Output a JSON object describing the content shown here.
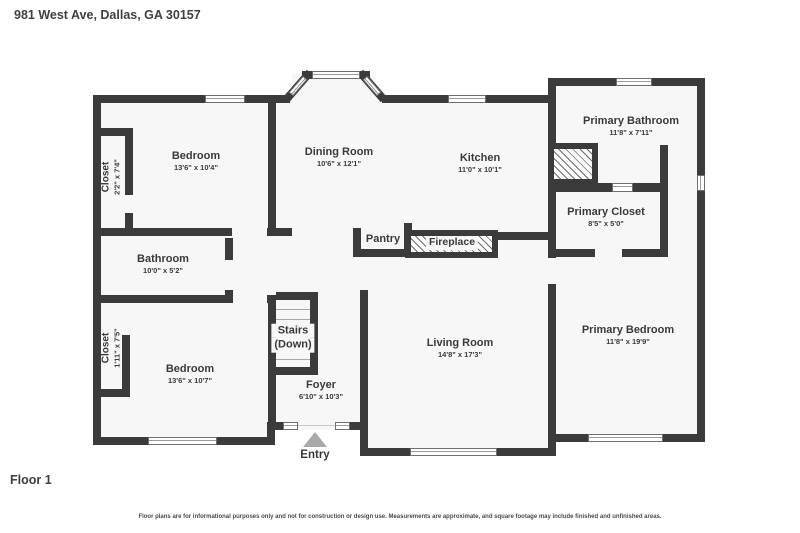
{
  "title": "981 West Ave, Dallas, GA 30157",
  "floor_label": "Floor 1",
  "disclaimer": "Floor plans are for informational purposes only and not for construction or design use. Measurements are approximate, and square footage may include finished and unfinished areas.",
  "entry_label": "Entry",
  "colors": {
    "wall": "#3b3b3b",
    "floor_fill": "#f7f7f7",
    "label_text": "#3a3a3a",
    "entry_arrow": "#a9a9a9"
  },
  "rooms": [
    {
      "id": "bedroom-1",
      "name": "Bedroom",
      "dims": "13'6\" x 10'4\""
    },
    {
      "id": "closet-1",
      "name": "Closet",
      "dims": "2'2\" x 7'4\""
    },
    {
      "id": "dining-room",
      "name": "Dining Room",
      "dims": "10'6\" x 12'1\""
    },
    {
      "id": "kitchen",
      "name": "Kitchen",
      "dims": "11'0\" x 10'1\""
    },
    {
      "id": "primary-bathroom",
      "name": "Primary Bathroom",
      "dims": "11'8\" x 7'11\""
    },
    {
      "id": "primary-closet",
      "name": "Primary Closet",
      "dims": "8'5\" x 5'0\""
    },
    {
      "id": "bathroom",
      "name": "Bathroom",
      "dims": "10'0\" x 5'2\""
    },
    {
      "id": "pantry",
      "name": "Pantry",
      "dims": ""
    },
    {
      "id": "fireplace",
      "name": "Fireplace",
      "dims": ""
    },
    {
      "id": "stairs",
      "name": "Stairs",
      "sub": "(Down)"
    },
    {
      "id": "bedroom-2",
      "name": "Bedroom",
      "dims": "13'6\" x 10'7\""
    },
    {
      "id": "closet-2",
      "name": "Closet",
      "dims": "1'11\" x 7'5\""
    },
    {
      "id": "foyer",
      "name": "Foyer",
      "dims": "6'10\" x 10'3\""
    },
    {
      "id": "living-room",
      "name": "Living Room",
      "dims": "14'8\" x 17'3\""
    },
    {
      "id": "primary-bedroom",
      "name": "Primary Bedroom",
      "dims": "11'8\" x 19'9\""
    }
  ]
}
